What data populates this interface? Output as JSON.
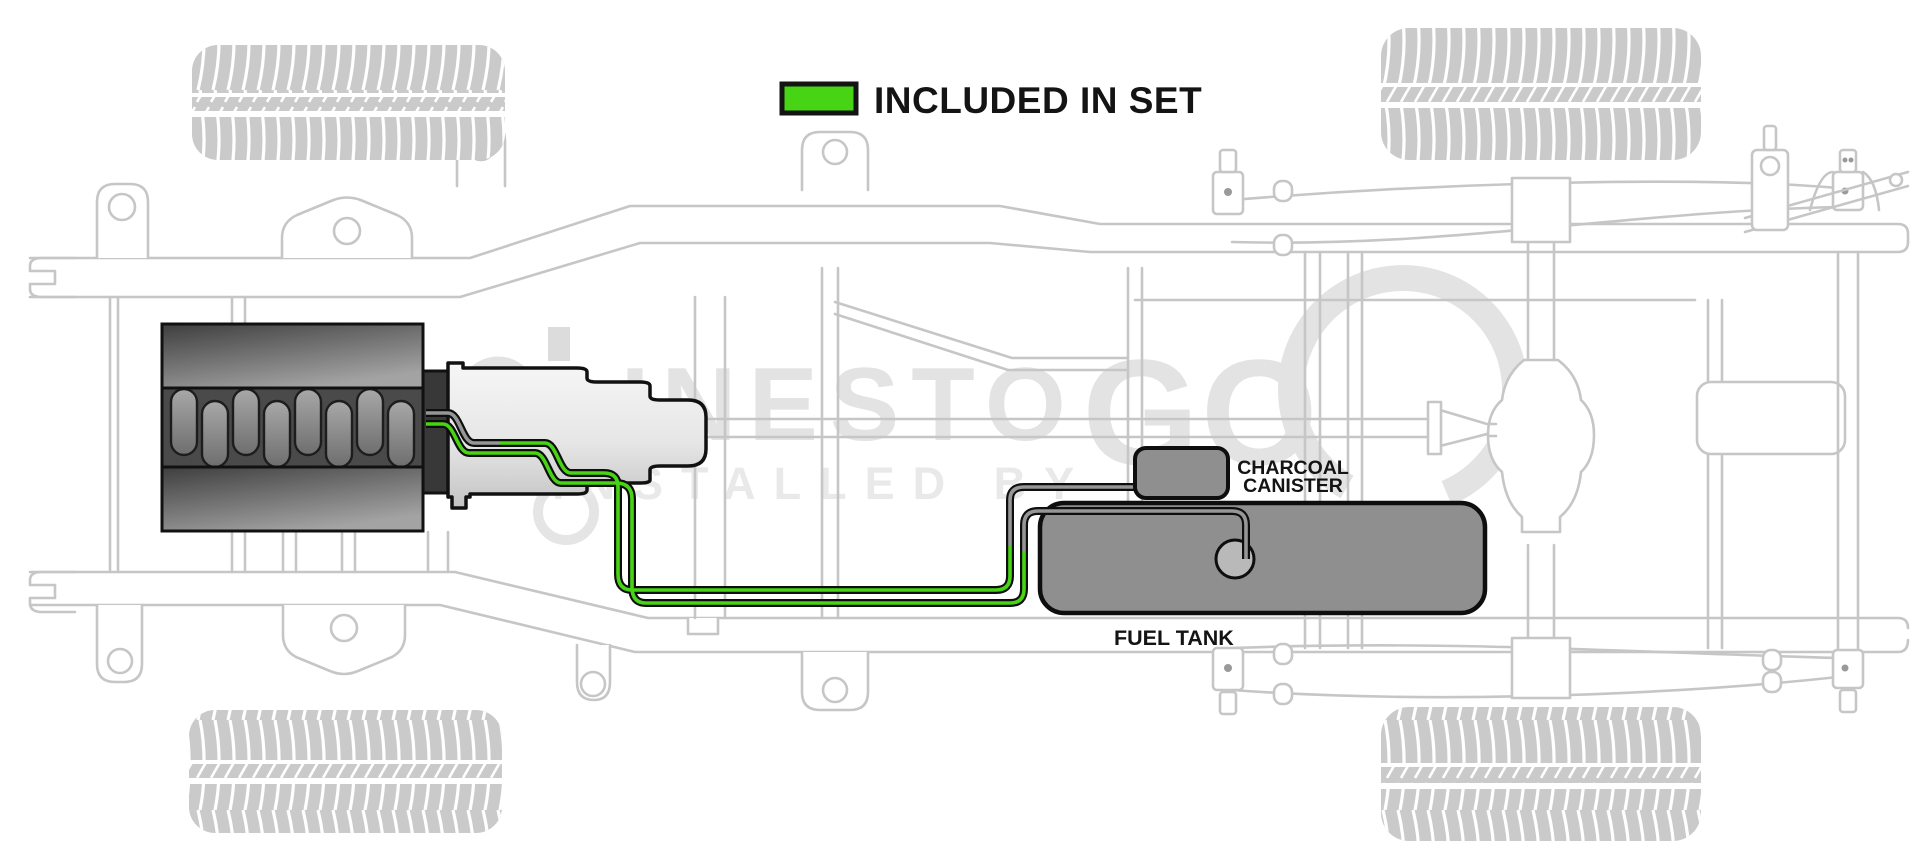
{
  "legend": {
    "label": "INCLUDED IN SET"
  },
  "labels": {
    "charcoal_canister_line1": "CHARCOAL",
    "charcoal_canister_line2": "CANISTER",
    "fuel_tank": "FUEL TANK"
  },
  "watermark": {
    "brand_main": "LINESTO",
    "brand_emphasis": "GO",
    "tagline": "INSTALLED BY"
  },
  "colors": {
    "included_green": "#47d414",
    "fuel_line_gray": "#969696",
    "tank_gray": "#8f8f8f",
    "chassis_gray": "#c6c6c6",
    "watermark_gray": "#e3e3e3",
    "casing_black": "#0e0e0e"
  }
}
